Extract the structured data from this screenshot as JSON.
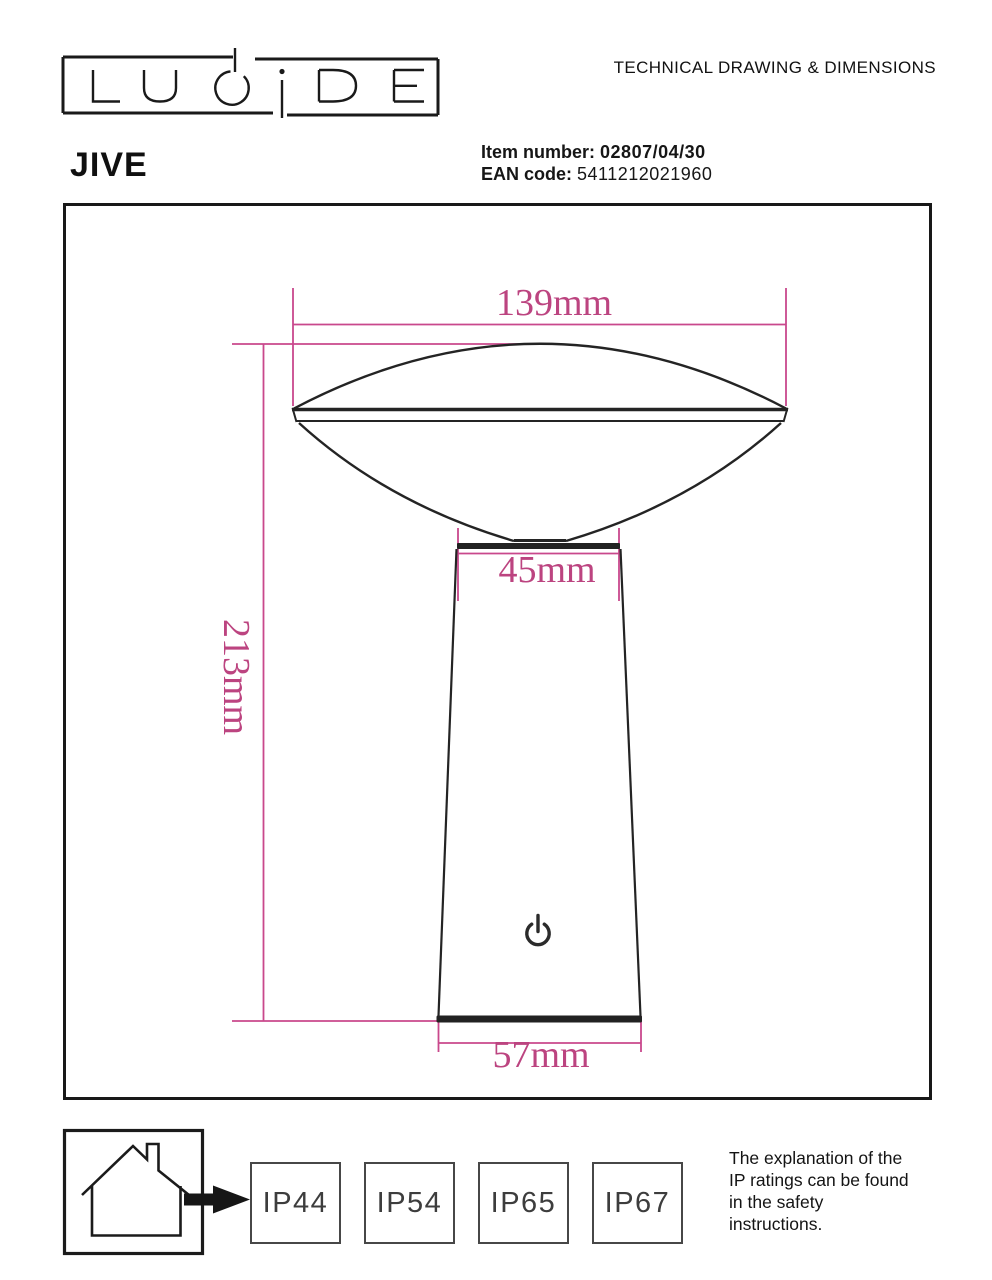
{
  "page": {
    "brand": "LUCIDE",
    "doc_title": "TECHNICAL DRAWING & DIMENSIONS",
    "product_name": "JIVE",
    "item_number_label": "Item number:",
    "item_number_value": "02807/04/30",
    "ean_label": "EAN code:",
    "ean_value": "5411212021960"
  },
  "drawing": {
    "type": "technical-drawing-table-lamp",
    "dim_top_width": "139mm",
    "dim_neck_width": "45mm",
    "dim_height": "213mm",
    "dim_base_width": "57mm",
    "icons": {
      "power": "power-symbol"
    },
    "colors": {
      "dimension_pink": "#c9488c",
      "line_black": "#242424"
    }
  },
  "footer": {
    "icons": {
      "house": "indoor-house",
      "arrow": "arrow-right"
    },
    "ip_ratings": [
      "IP44",
      "IP54",
      "IP65",
      "IP67"
    ],
    "note": "The explanation of the\nIP ratings can be found\nin the safety\ninstructions."
  }
}
